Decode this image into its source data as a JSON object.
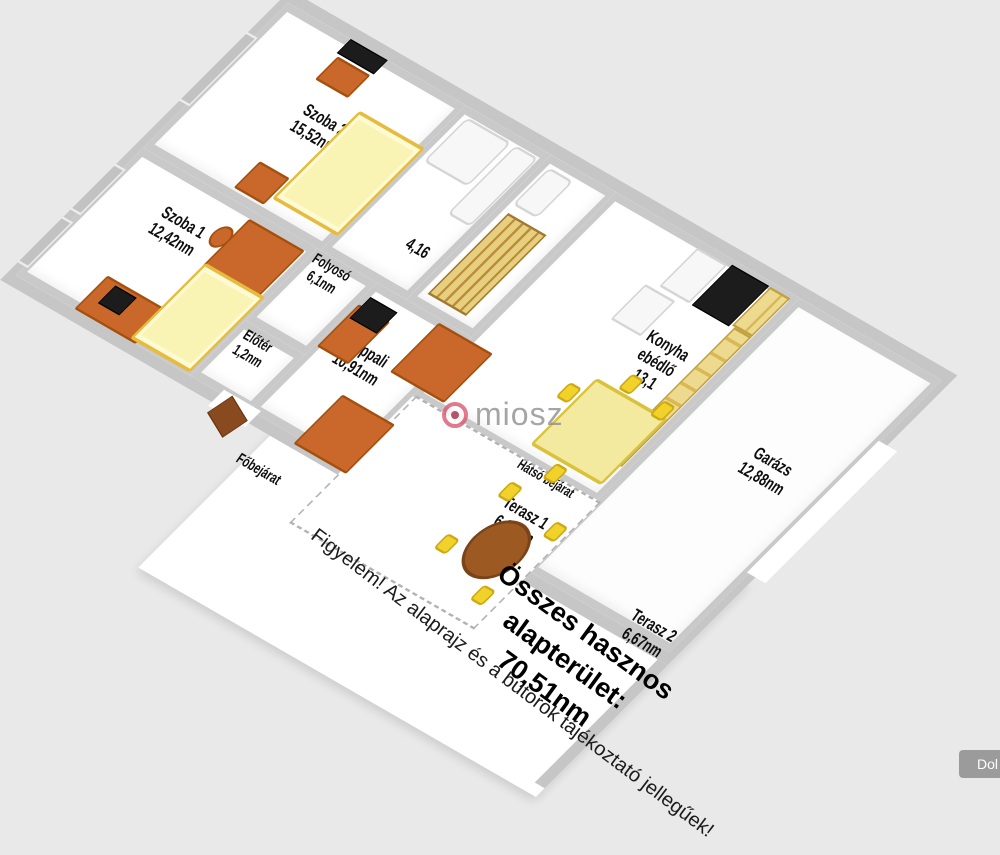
{
  "watermark": {
    "text": "miosz"
  },
  "summary": {
    "title": "Összes hasznos alapterület:",
    "value": "70,51nm"
  },
  "disclaimer": "Figyelem! Az alaprajz és a bútorok tájékoztató jellegűek!",
  "corner_button": {
    "label": "Dol"
  },
  "entrances": {
    "main": "Főbejárat",
    "back": "Hátsó bejárat"
  },
  "rooms": [
    {
      "id": "szoba2",
      "name": "Szoba 2",
      "area": "15,52nm"
    },
    {
      "id": "szoba1",
      "name": "Szoba 1",
      "area": "12,42nm"
    },
    {
      "id": "hall",
      "name": "",
      "area": "4,16"
    },
    {
      "id": "wc",
      "name": "WC",
      "area": ""
    },
    {
      "id": "folyoso",
      "name": "Folyosó",
      "area": "6,1nm"
    },
    {
      "id": "eloter",
      "name": "Előtér",
      "area": "1,2nm"
    },
    {
      "id": "nappali",
      "name": "Nappali",
      "area": "10,91nm"
    },
    {
      "id": "konyha",
      "name": "Konyha ebédlő",
      "area": "13,1"
    },
    {
      "id": "garazs",
      "name": "Garázs",
      "area": "12,88nm"
    },
    {
      "id": "terasz1",
      "name": "Terasz 1",
      "area": "6,20nm"
    },
    {
      "id": "terasz2",
      "name": "Terasz 2",
      "area": "6,67nm"
    }
  ],
  "colors": {
    "background": "#e9e9e9",
    "wall": "#c6c6c6",
    "floor": "#ffffff",
    "furniture_orange": "#c9682a",
    "bed_yellow": "#faf4b4",
    "kitchen_yellow": "#eeda8f",
    "appliance_black": "#1c1c1c",
    "window_gray": "#c2c2c2",
    "watermark_pink": "#d95b72",
    "watermark_gray": "#8f8f8f"
  }
}
